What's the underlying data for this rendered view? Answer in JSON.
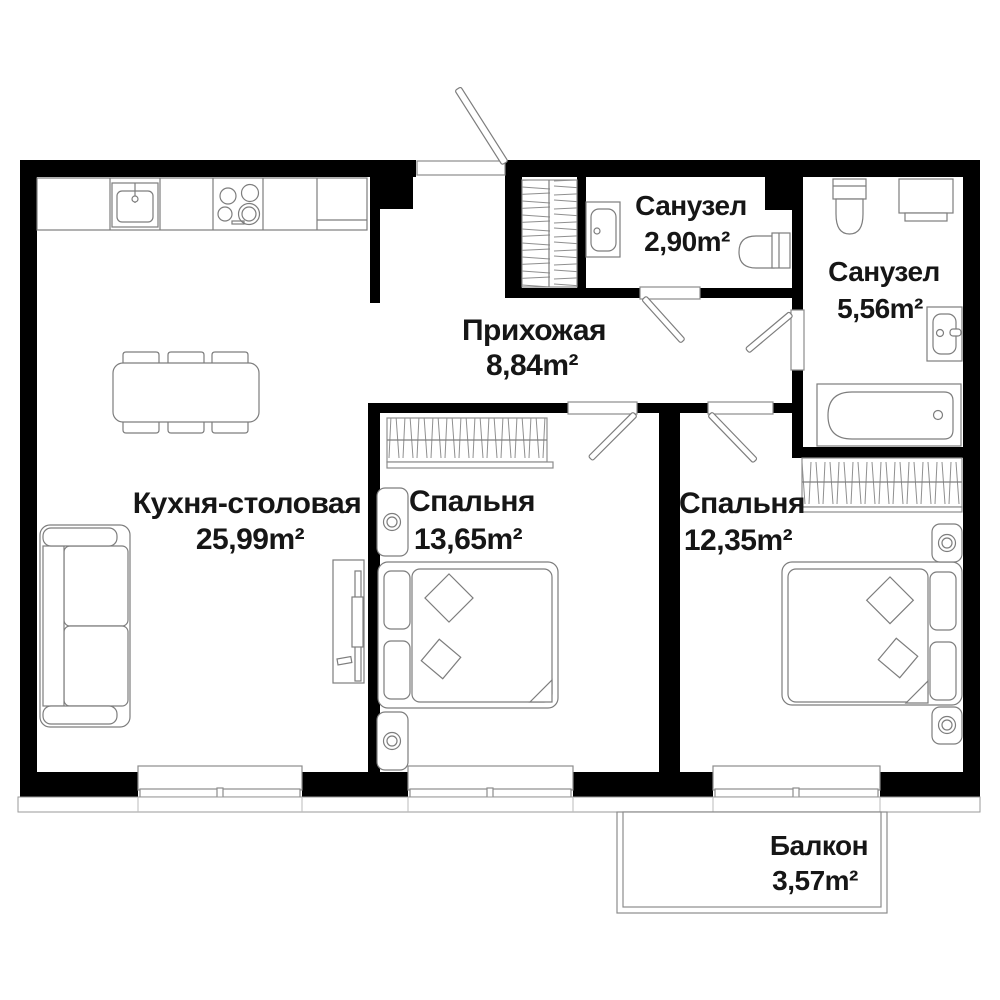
{
  "plan": {
    "title": "Apartment floor plan",
    "rooms": {
      "kitchen_dining": {
        "name": "Кухня-столовая",
        "area": "25,99m²"
      },
      "hallway": {
        "name": "Прихожая",
        "area": "8,84m²"
      },
      "bathroom_small": {
        "name": "Санузел",
        "area": "2,90m²"
      },
      "bathroom_large": {
        "name": "Санузел",
        "area": "5,56m²"
      },
      "bedroom_1": {
        "name": "Спальня",
        "area": "13,65m²"
      },
      "bedroom_2": {
        "name": "Спальня",
        "area": "12,35m²"
      },
      "balcony": {
        "name": "Балкон",
        "area": "3,57m²"
      }
    },
    "furniture_icons": [
      "kitchen-counter-icon",
      "kitchen-sink-icon",
      "stove-icon",
      "dining-table-icon",
      "chair-icon",
      "sofa-icon",
      "tv-unit-icon",
      "wardrobe-icon",
      "closet-icon",
      "double-bed-icon",
      "pillow-icon",
      "cushion-icon",
      "nightstand-icon",
      "toilet-icon",
      "washing-machine-icon",
      "bathtub-icon",
      "vanity-sink-icon",
      "door-swing-icon",
      "window-icon",
      "balcony-icon"
    ],
    "colors": {
      "wall": "#000000",
      "outline": "#7d7d7d",
      "text": "#161616",
      "background": "#ffffff"
    }
  }
}
